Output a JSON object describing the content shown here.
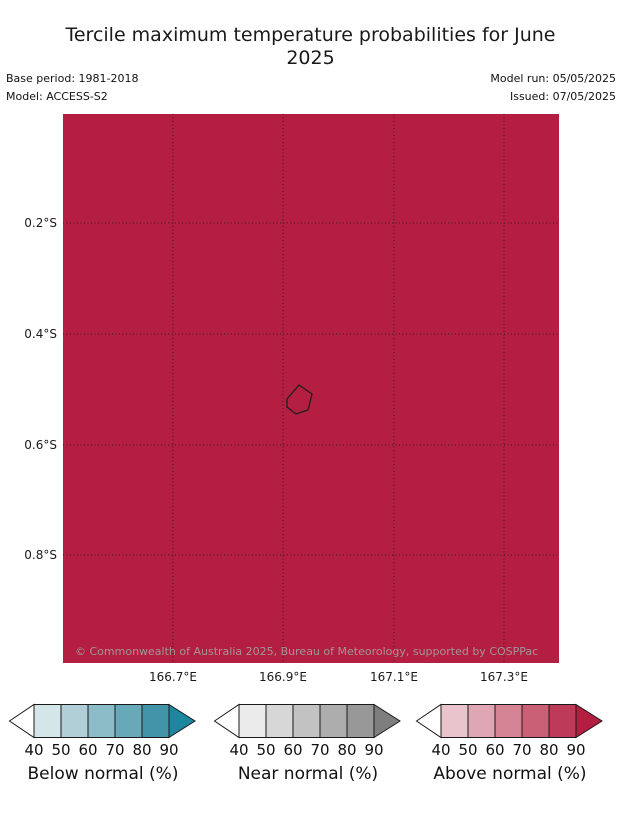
{
  "title": "Tercile maximum temperature probabilities for June 2025",
  "meta": {
    "base_period": "Base period: 1981-2018",
    "model": "Model: ACCESS-S2",
    "model_run": "Model run: 05/05/2025",
    "issued": "Issued: 07/05/2025"
  },
  "map": {
    "fill_color": "#b41e40",
    "grid_color": "#1a1a1a",
    "island_outline_color": "#1f1f1f",
    "y_ticks": [
      "0.2°S",
      "0.4°S",
      "0.6°S",
      "0.8°S"
    ],
    "x_ticks": [
      "166.7°E",
      "166.9°E",
      "167.1°E",
      "167.3°E"
    ],
    "copyright": "© Commonwealth of Australia 2025, Bureau of Meteorology, supported by COSPPac"
  },
  "legends": [
    {
      "label": "Below normal (%)",
      "ticks": [
        "40",
        "50",
        "60",
        "70",
        "80",
        "90"
      ],
      "colors": [
        "#d5e6e9",
        "#b1cfd6",
        "#8bbcc8",
        "#67a9b8",
        "#4295a9"
      ],
      "arrow_left_color": "#ffffff",
      "arrow_right_color": "#1e87a0"
    },
    {
      "label": "Near normal (%)",
      "ticks": [
        "40",
        "50",
        "60",
        "70",
        "80",
        "90"
      ],
      "colors": [
        "#ebebeb",
        "#d7d7d7",
        "#c2c2c2",
        "#adadad",
        "#989898"
      ],
      "arrow_left_color": "#ffffff",
      "arrow_right_color": "#7e7e7e"
    },
    {
      "label": "Above normal (%)",
      "ticks": [
        "40",
        "50",
        "60",
        "70",
        "80",
        "90"
      ],
      "colors": [
        "#e9c4cd",
        "#dfa6b3",
        "#d58495",
        "#c96076",
        "#bd3a58"
      ],
      "arrow_left_color": "#ffffff",
      "arrow_right_color": "#b41e40"
    }
  ],
  "chart_data": {
    "type": "heatmap",
    "title": "Tercile maximum temperature probabilities for June 2025",
    "subtitle_meta": [
      "Base period: 1981-2018",
      "Model: ACCESS-S2",
      "Model run: 05/05/2025",
      "Issued: 07/05/2025"
    ],
    "x": {
      "label": "Longitude",
      "tick_labels": [
        "166.7°E",
        "166.9°E",
        "167.1°E",
        "167.3°E"
      ],
      "range": [
        "166.5°E",
        "167.4°E"
      ]
    },
    "y": {
      "label": "Latitude",
      "tick_labels": [
        "0.2°S",
        "0.4°S",
        "0.6°S",
        "0.8°S"
      ],
      "range": [
        "0.0°S",
        "1.0°S"
      ]
    },
    "grid": "dotted graticule at labeled ticks",
    "field": "Uniform above-normal tercile probability greater than 90% over the whole domain (solid crimson fill matching the >90 arrow of the Above normal colorbar)",
    "overlay": "Nauru island coastline outline centered near 166.93°E, 0.52°S",
    "legend_position": "bottom row, three horizontal colorbars",
    "colorbars": [
      {
        "title": "Below normal (%)",
        "tick_values": [
          40,
          50,
          60,
          70,
          80,
          90
        ],
        "segment_colors": [
          "#d5e6e9",
          "#b1cfd6",
          "#8bbcc8",
          "#67a9b8",
          "#4295a9"
        ],
        "over_arrow_color": "#1e87a0",
        "under_arrow_color": "#ffffff"
      },
      {
        "title": "Near normal (%)",
        "tick_values": [
          40,
          50,
          60,
          70,
          80,
          90
        ],
        "segment_colors": [
          "#ebebeb",
          "#d7d7d7",
          "#c2c2c2",
          "#adadad",
          "#989898"
        ],
        "over_arrow_color": "#7e7e7e",
        "under_arrow_color": "#ffffff"
      },
      {
        "title": "Above normal (%)",
        "tick_values": [
          40,
          50,
          60,
          70,
          80,
          90
        ],
        "segment_colors": [
          "#e9c4cd",
          "#dfa6b3",
          "#d58495",
          "#c96076",
          "#bd3a58"
        ],
        "over_arrow_color": "#b41e40",
        "under_arrow_color": "#ffffff"
      }
    ]
  }
}
